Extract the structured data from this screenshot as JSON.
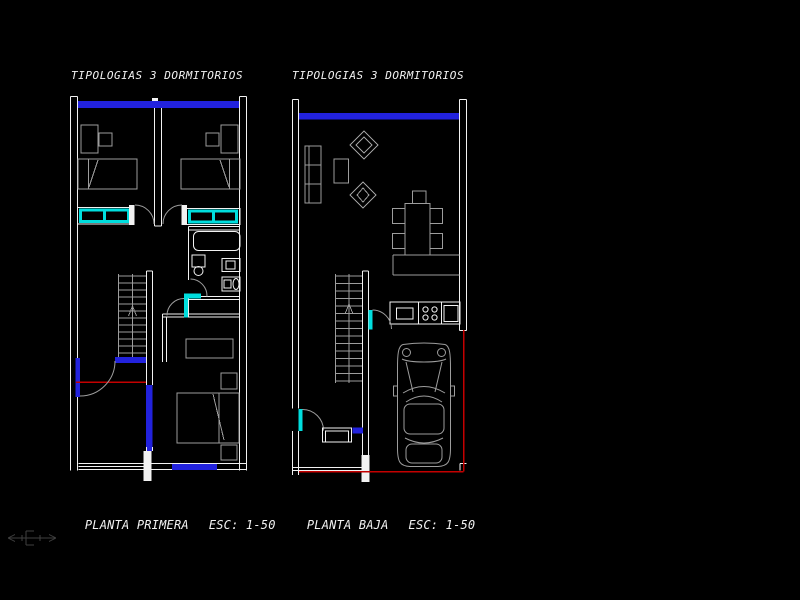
{
  "viewport": {
    "background": "#000000"
  },
  "plans": {
    "primera": {
      "title": "TIPOLOGIAS 3 DORMITORIOS",
      "caption": "PLANTA PRIMERA",
      "scale_label": "ESC: 1-50"
    },
    "baja": {
      "title": "TIPOLOGIAS 3 DORMITORIOS",
      "caption": "PLANTA BAJA",
      "scale_label": "ESC: 1-50"
    }
  },
  "colors": {
    "background": "#000000",
    "wall": "#f2f2f2",
    "furniture": "#9d9d9d",
    "window": "#2222dd",
    "fixture_cyan": "#00dede",
    "boundary_red": "#c40000",
    "ucs": "#3f3f3f",
    "text": "#f2f2f2"
  },
  "icons": {
    "ucs": "ucs-axis-icon"
  }
}
